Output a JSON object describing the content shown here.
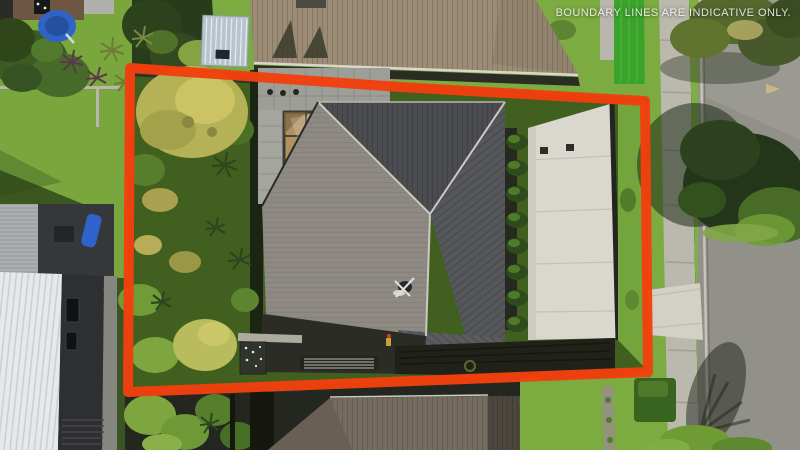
{
  "watermark": {
    "text": "BOUNDARY LINES ARE INDICATIVE ONLY.",
    "color": "#ffffff"
  },
  "boundary": {
    "color": "#f2400d",
    "stroke_width": 10,
    "shape": "quadrilateral property outline"
  },
  "scene": {
    "type": "aerial-drone-photo",
    "subject": "single residential section outlined in red: dark hipped-roof house, bronze pergola, concrete driveway with hedge row, dense left-side garden",
    "regions": [
      "left-neighbor-properties",
      "top-neighbor-tan-roof",
      "subject-property",
      "bottom-neighbor-roof",
      "street-with-footpath-and-berm",
      "street-trees"
    ]
  },
  "palette": {
    "boundary_red": "#f2400d",
    "roof_dark": "#4a4c4f",
    "roof_light": "#8e8a83",
    "roof_tan": "#9c8c76",
    "roof_bottom_neighbor": "#756c60",
    "roof_white": "#e7e8e9",
    "driveway_concrete": "#dad7ce",
    "road_asphalt": "#91918a",
    "footpath": "#bbb8ae",
    "lawn_green": "#7cab41",
    "garden_dark_green": "#41601f",
    "artificial_turf": "#3ba22c",
    "pergola_bronze": "#b19162",
    "pool_blue": "#2f64c4",
    "shed_blue_grey": "#b8c4cc"
  }
}
